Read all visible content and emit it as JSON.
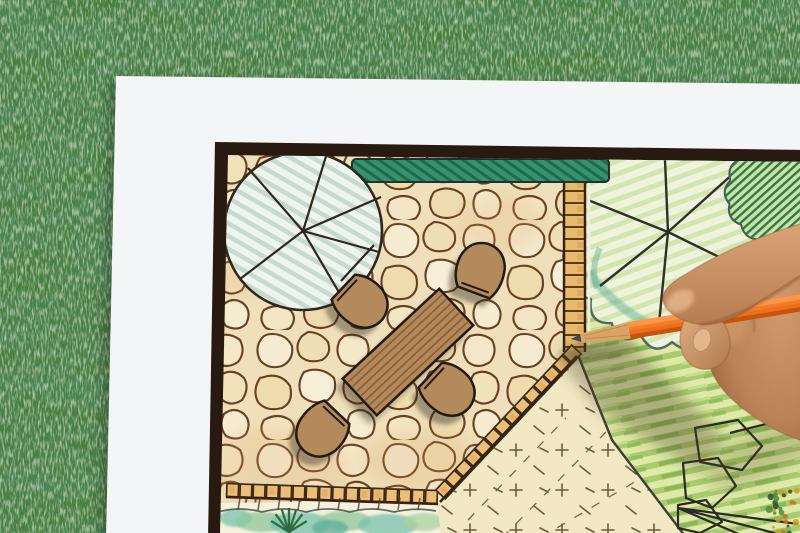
{
  "scene": {
    "kind": "photograph",
    "description_labels": {
      "grass": "artificial grass background",
      "paper": "white drawing paper sheet",
      "plan": "hand-drawn garden landscape plan",
      "plan_border": "dark plan border frame",
      "patio": "flagstone patio",
      "hedge": "hedge row symbol",
      "tree_large": "large round tree symbol",
      "tree_right": "scalloped tree canopy symbol",
      "shrub": "hatched shrub symbol",
      "walkway": "paver walkway",
      "paver_edge": "paver edge band",
      "table": "rectangular wooden table symbol",
      "chair": "chair symbol",
      "lawn_cream": "open lawn with cross marks",
      "lawn_green": "green lawn colored pencil strokes",
      "bed": "planting bed with shrubs",
      "fern": "fern plant symbol",
      "rocks": "boulder outlines",
      "hand": "hand holding pencil",
      "pencil": "orange colored pencil"
    },
    "counts": {
      "chairs": 4,
      "trees": 2
    },
    "palette": {
      "grass_base": "#4a8041",
      "grass_dark": "#16401a",
      "grass_light": "#8cb87f",
      "paper": "#f3f5f6",
      "frame": "#281a10",
      "stone_bg": "#efe0bb",
      "stone_line": "#6b3f22",
      "paver": "#ecbe77",
      "paver_line": "#3a2a16",
      "hedge_green": "#37906e",
      "hedge_dark": "#1d6b4e",
      "tree_hatch_mint": "#c4dccf",
      "tree_fill": "#eff5ee",
      "garden_green": "#dfe9a8",
      "garden_row": "#abcb70",
      "lawn_cream": "#f2e9c4",
      "mark_brown": "#6b5b3c",
      "wood_table": "#b5885a",
      "wood_stripe": "#84603a",
      "chair_fill": "#b28a5c",
      "outline_dark": "#241a10",
      "teal_wash": "#79c2ae",
      "fern_green": "#2f6b3f",
      "pencil_orange": "#ed6f1d",
      "pencil_highlight": "#ff9d4f",
      "pencil_shadow": "#c14f0b",
      "pencil_wood": "#d8a567",
      "graphite": "#474747",
      "skin_mid": "#c08a5e",
      "skin_light": "#dba478",
      "skin_dark": "#9a6742"
    }
  }
}
